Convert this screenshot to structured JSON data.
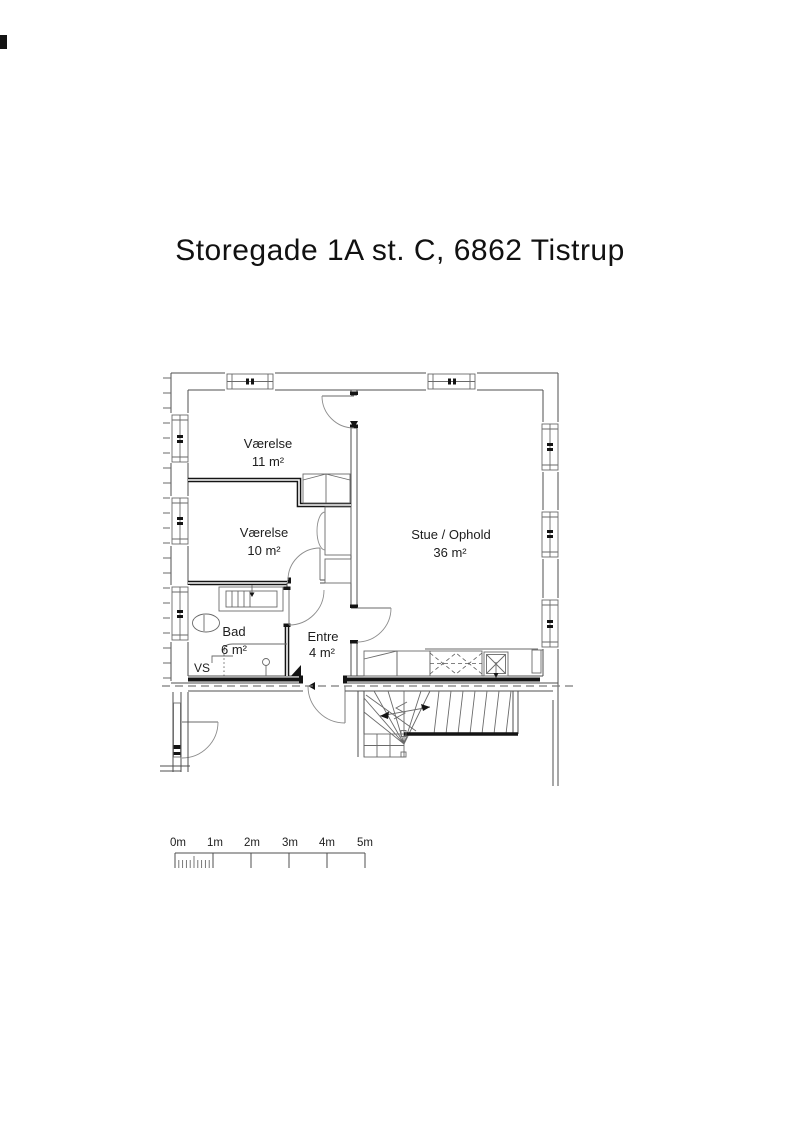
{
  "title": "Storegade 1A st. C, 6862 Tistrup",
  "floor_plan": {
    "rooms": [
      {
        "name": "Værelse",
        "area": "11 m²"
      },
      {
        "name": "Værelse",
        "area": "10 m²"
      },
      {
        "name": "Stue / Ophold",
        "area": "36 m²"
      },
      {
        "name": "Bad",
        "area": "6 m²"
      },
      {
        "name": "Entre",
        "area": "4 m²"
      }
    ],
    "technical_label": "VS"
  },
  "scale_bar": {
    "labels": [
      "0m",
      "1m",
      "2m",
      "3m",
      "4m",
      "5m"
    ]
  },
  "colors": {
    "background": "#ffffff",
    "line": "#4f4f4f",
    "wall_dark": "#141414",
    "text": "#1d1d1d"
  }
}
